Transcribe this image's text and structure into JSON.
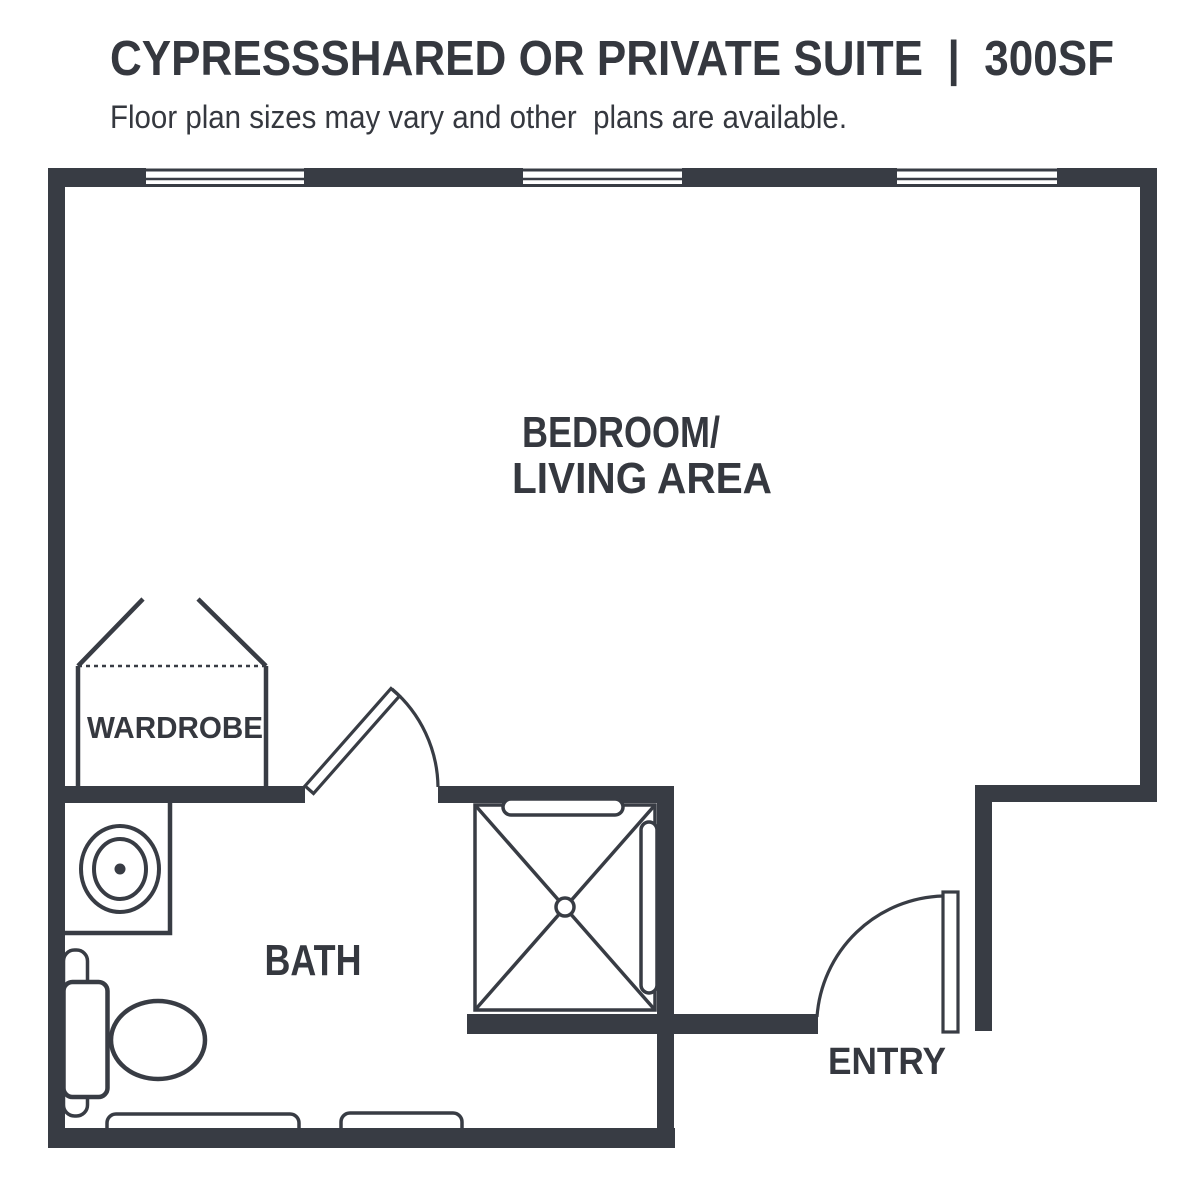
{
  "header": {
    "title": "CYPRESSSHARED OR PRIVATE SUITE  |  300SF",
    "subtitle": "Floor plan sizes may vary and other  plans are available."
  },
  "rooms": {
    "bedroom_living_line1": "BEDROOM/",
    "bedroom_living_line2": "LIVING AREA",
    "wardrobe": "WARDROBE",
    "bath": "BATH",
    "entry": "ENTRY"
  },
  "colors": {
    "wall": "#383c44",
    "text": "#35383f",
    "background": "#ffffff"
  }
}
